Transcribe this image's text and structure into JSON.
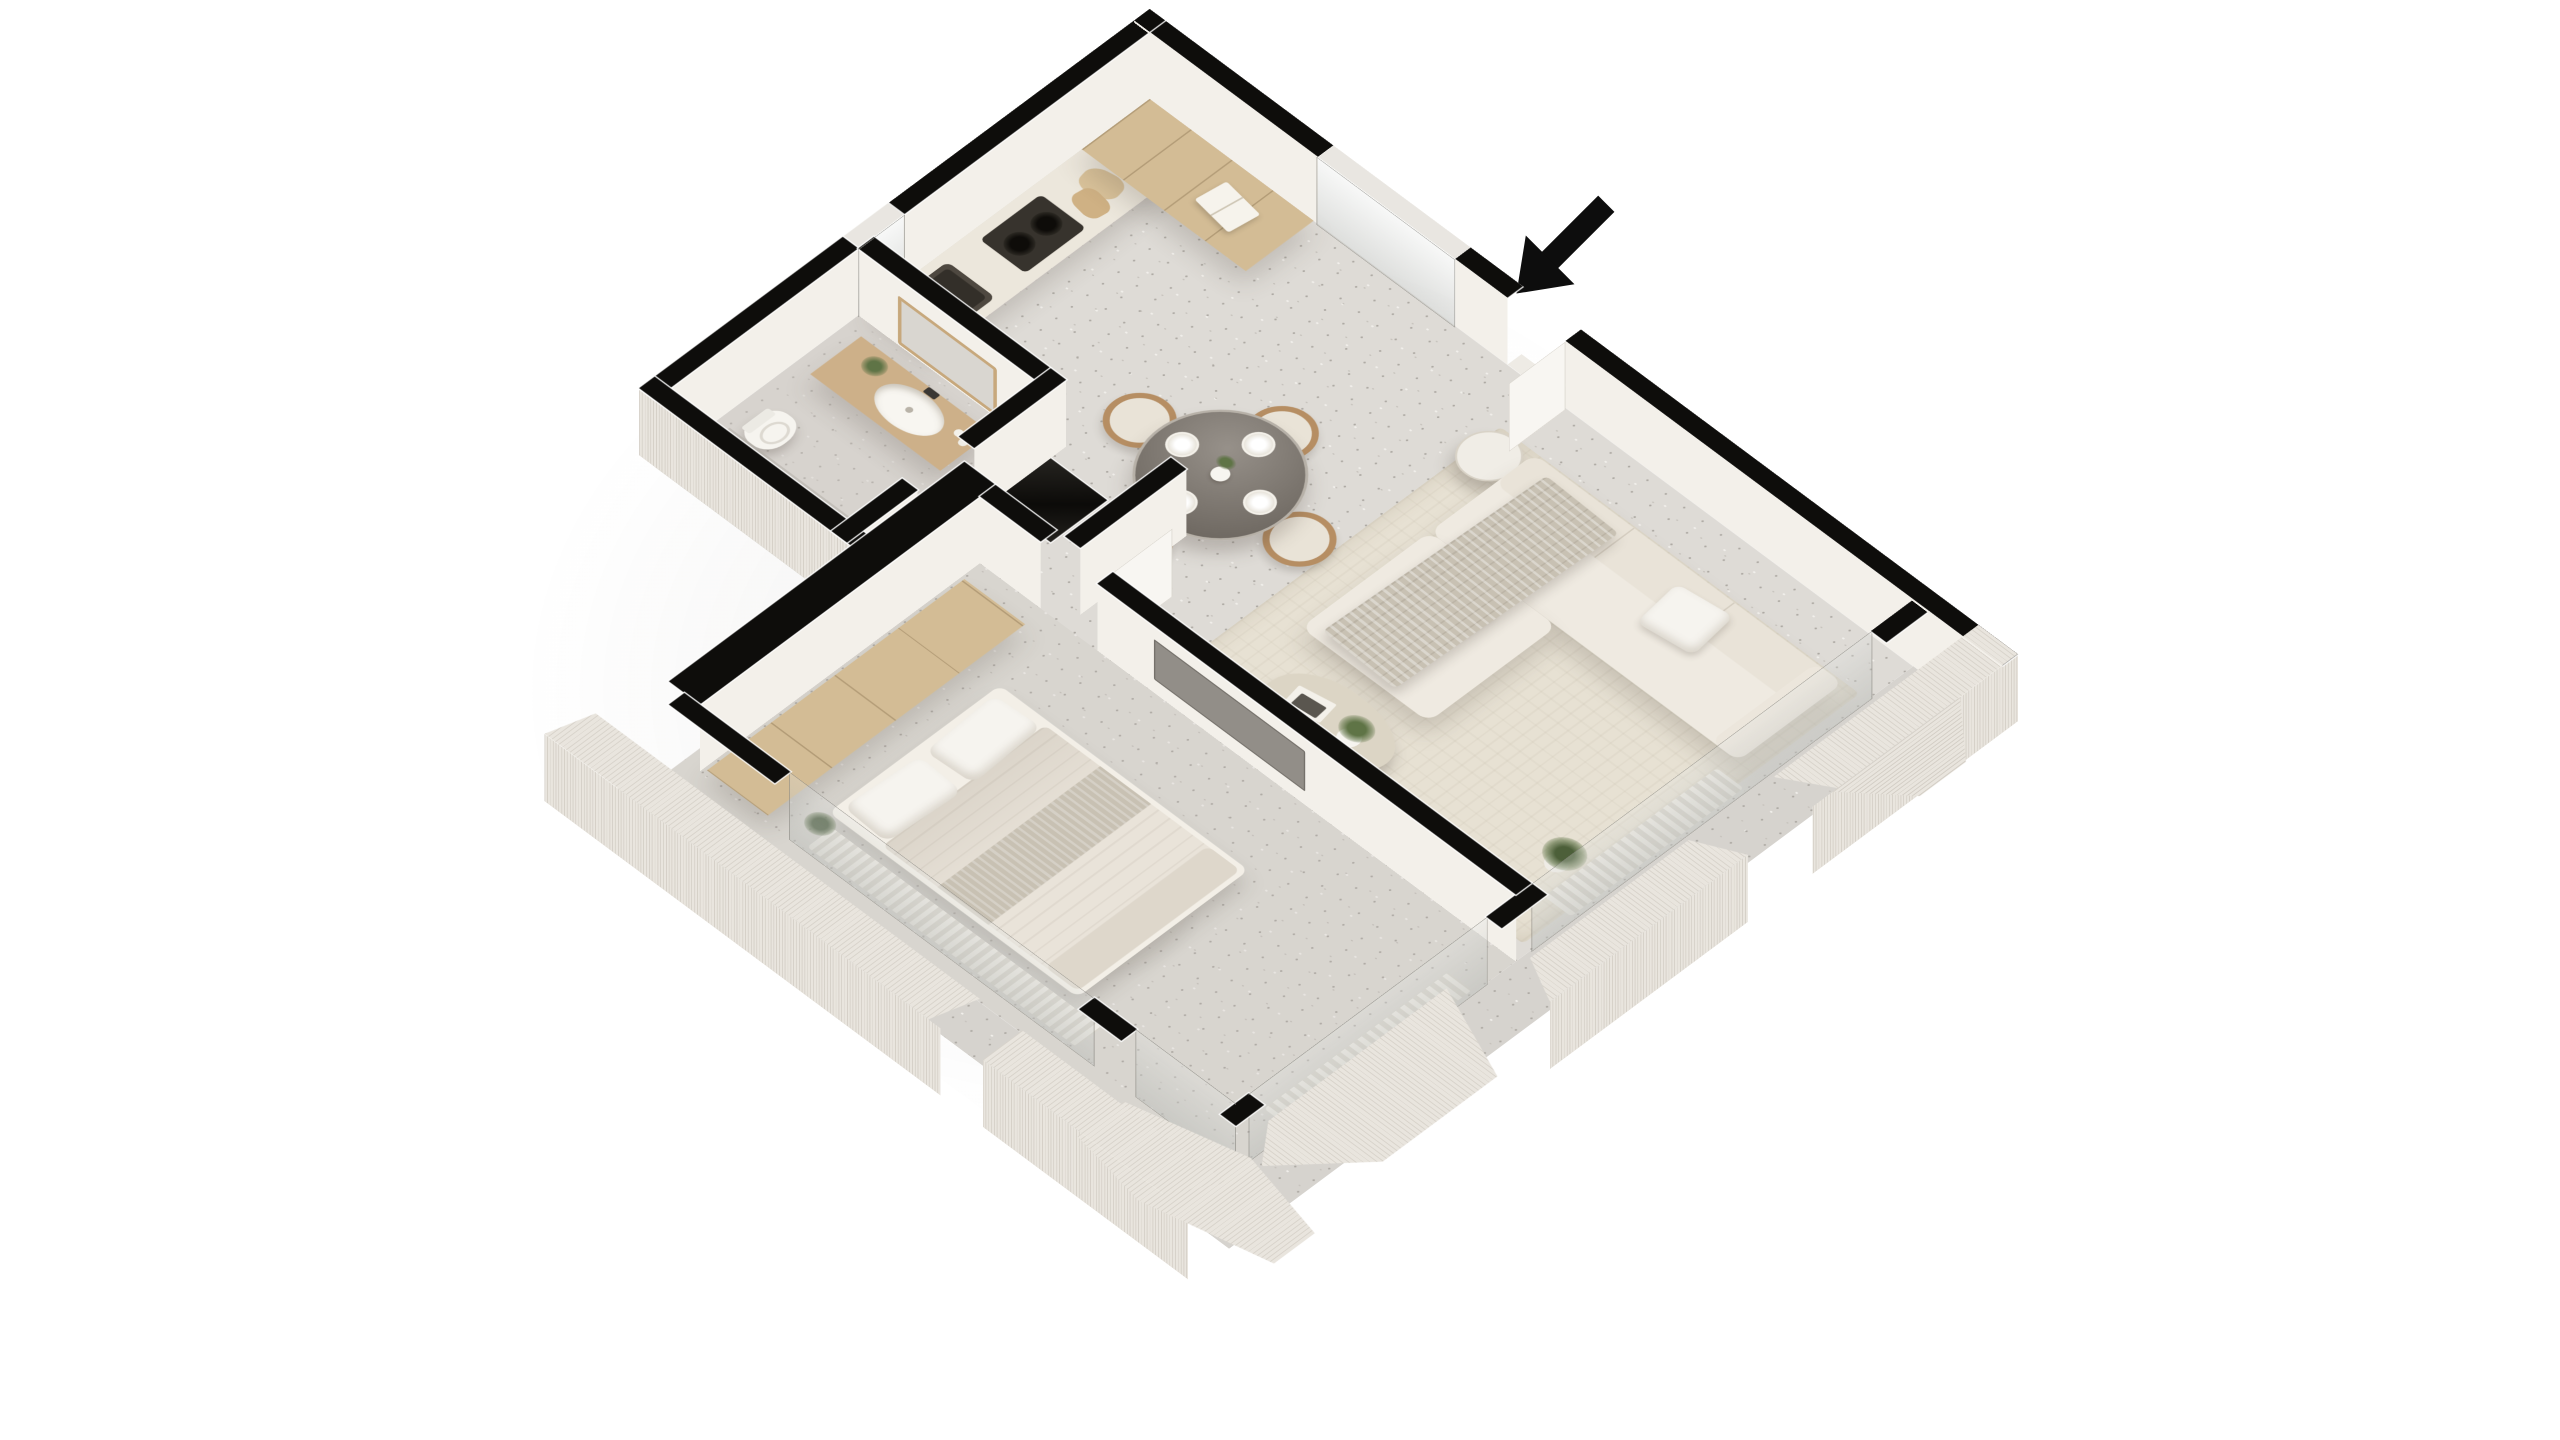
{
  "scene": {
    "description": "3D isometric cutaway floor plan rendering of a one-bedroom apartment on a white background",
    "background": "#ffffff",
    "projection": "isometric"
  },
  "entrance": {
    "arrow_direction": "down-left",
    "label": "entrance"
  },
  "colors": {
    "wall": "#0e0d0b",
    "wall_face": "#f3f0ea",
    "exterior_wall": "#e9e5de",
    "floor": "#dedbd6",
    "floor_dot_dark": "#aeaaa4",
    "floor_dot_mid": "#c6c2bc",
    "floor_dot_light": "#f1efeb",
    "rug": "#e7e1d3",
    "oak": "#d3bc95",
    "oak_dark": "#bb9a6a",
    "counter_top": "#ece7dc",
    "steel_dark": "#46413b",
    "cream": "#efeae1",
    "cream_shadow": "#ded6c8",
    "bedding": "#e9e3d9",
    "throw": "#c8c1b3",
    "wood_warm": "#b68e63",
    "glass_table": "#87817a",
    "white_soft": "#f6f4ef",
    "curtain_a": "#efece5",
    "curtain_b": "#d9d5cc",
    "plant": "#5f7446",
    "flower": "#9c2733",
    "tv": "#928e88"
  },
  "rooms": {
    "kitchen": {
      "label": "Kitchen",
      "items": [
        "tall cabinets",
        "counter with oak fronts",
        "gas hob",
        "built-in oven",
        "double sink",
        "cutting boards",
        "cookbook",
        "red flowers"
      ]
    },
    "dining_area": {
      "label": "Dining area",
      "items": [
        "round smoked-glass table",
        "four wooden chairs",
        "four place settings",
        "white vase with greenery"
      ]
    },
    "living_room": {
      "label": "Living room",
      "items": [
        "L-shaped cream sofa",
        "throw blanket",
        "cushions",
        "round side table",
        "organic coffee table",
        "books and candles",
        "potted plants",
        "area rug",
        "sheer curtains"
      ]
    },
    "bedroom": {
      "label": "Bedroom",
      "items": [
        "double bed",
        "two pillows",
        "greige throw",
        "built-in wardrobe",
        "wall TV panel",
        "corner glazing",
        "curtain"
      ]
    },
    "bathroom": {
      "label": "Bathroom",
      "items": [
        "oak vanity",
        "oval vessel basin",
        "wall mirror",
        "toilet",
        "walk-in shower with linear drain",
        "glass screen",
        "plant"
      ]
    },
    "hallway": {
      "label": "Hallway",
      "items": [
        "tall black storage unit",
        "bedroom door",
        "bathroom door"
      ]
    },
    "balcony": {
      "label": "Balcony",
      "items": [
        "glazed sliding doors",
        "angular parapet walls",
        "deck"
      ]
    }
  }
}
